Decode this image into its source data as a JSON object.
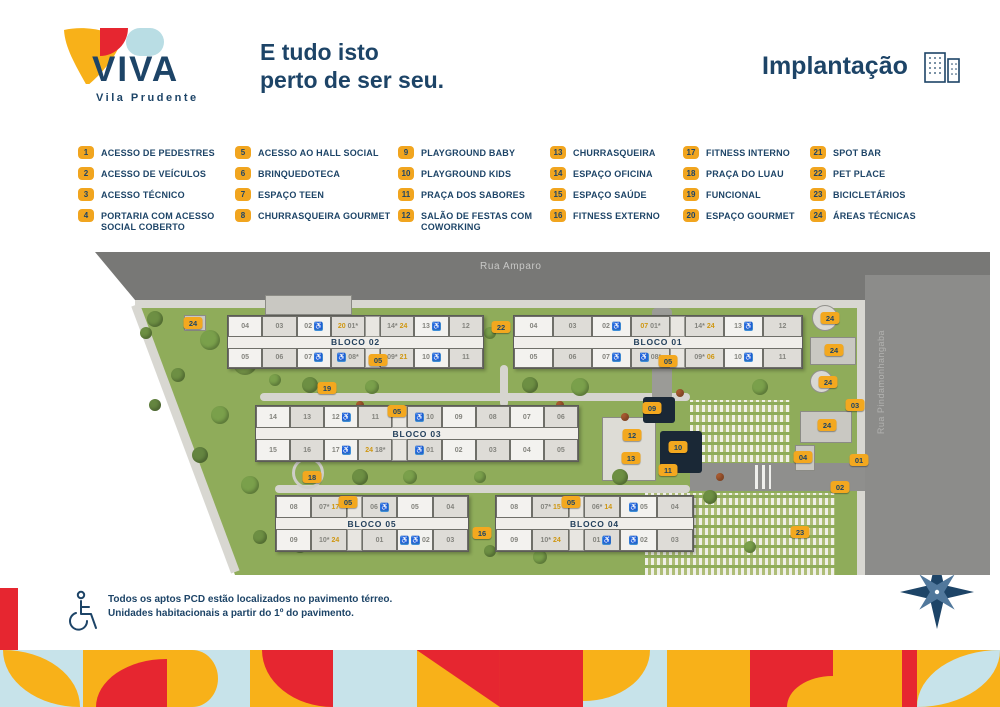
{
  "colors": {
    "navy": "#1d4467",
    "red": "#e62630",
    "yellow": "#f8b119",
    "legend_badge": "#f1a51f",
    "light_blue": "#c7e3ea",
    "grass": "#8fac5a",
    "road": "#787876",
    "accessibility_blue": "#3f8fd8",
    "gold": "#cf9712"
  },
  "icons": {
    "accessibility_glyph": "♿"
  },
  "header": {
    "logo_text": "VIVA",
    "logo_subtitle": "Vila Prudente",
    "tagline_line1": "E tudo isto",
    "tagline_line2": "perto de ser seu.",
    "section_title": "Implantação"
  },
  "legend": {
    "columns": [
      [
        {
          "num": "1",
          "label": "ACESSO DE PEDESTRES"
        },
        {
          "num": "2",
          "label": "ACESSO DE VEÍCULOS"
        },
        {
          "num": "3",
          "label": "ACESSO TÉCNICO"
        },
        {
          "num": "4",
          "label": "PORTARIA COM ACESSO SOCIAL COBERTO"
        }
      ],
      [
        {
          "num": "5",
          "label": "ACESSO AO HALL SOCIAL"
        },
        {
          "num": "6",
          "label": "BRINQUEDOTECA"
        },
        {
          "num": "7",
          "label": "ESPAÇO TEEN"
        },
        {
          "num": "8",
          "label": "CHURRASQUEIRA GOURMET"
        }
      ],
      [
        {
          "num": "9",
          "label": "PLAYGROUND BABY"
        },
        {
          "num": "10",
          "label": "PLAYGROUND KIDS"
        },
        {
          "num": "11",
          "label": "PRAÇA DOS SABORES"
        },
        {
          "num": "12",
          "label": "SALÃO DE FESTAS COM COWORKING"
        }
      ],
      [
        {
          "num": "13",
          "label": "CHURRASQUEIRA"
        },
        {
          "num": "14",
          "label": "ESPAÇO OFICINA"
        },
        {
          "num": "15",
          "label": "ESPAÇO SAÚDE"
        },
        {
          "num": "16",
          "label": "FITNESS EXTERNO"
        }
      ],
      [
        {
          "num": "17",
          "label": "FITNESS INTERNO"
        },
        {
          "num": "18",
          "label": "PRAÇA DO LUAU"
        },
        {
          "num": "19",
          "label": "FUNCIONAL"
        },
        {
          "num": "20",
          "label": "ESPAÇO GOURMET"
        }
      ],
      [
        {
          "num": "21",
          "label": "SPOT BAR"
        },
        {
          "num": "22",
          "label": "PET PLACE"
        },
        {
          "num": "23",
          "label": "BICICLETÁRIOS"
        },
        {
          "num": "24",
          "label": "ÁREAS TÉCNICAS"
        }
      ]
    ]
  },
  "map": {
    "street_top": "Rua Amparo",
    "street_right": "Rua Pindamonhangaba",
    "blocks": [
      {
        "name": "BLOCO 02",
        "x": 167,
        "y": 70,
        "w": 255,
        "h": 52,
        "top": [
          {
            "p": [
              [
                "u",
                "04"
              ]
            ]
          },
          {
            "p": [
              [
                "u",
                "03"
              ]
            ]
          },
          {
            "p": [
              [
                "u",
                "02"
              ],
              [
                "w"
              ]
            ]
          },
          {
            "p": [
              [
                "g",
                "20"
              ],
              [
                "u",
                "01*"
              ]
            ]
          },
          {
            "e": 1
          },
          {
            "p": [
              [
                "u",
                "14*"
              ],
              [
                "g",
                "24"
              ]
            ]
          },
          {
            "p": [
              [
                "u",
                "13"
              ],
              [
                "w"
              ]
            ]
          },
          {
            "p": [
              [
                "u",
                "12"
              ]
            ]
          }
        ],
        "bottom": [
          {
            "p": [
              [
                "u",
                "05"
              ]
            ]
          },
          {
            "p": [
              [
                "u",
                "06"
              ]
            ]
          },
          {
            "p": [
              [
                "u",
                "07"
              ],
              [
                "w"
              ]
            ]
          },
          {
            "p": [
              [
                "w"
              ],
              [
                "u",
                "08*"
              ]
            ]
          },
          {
            "e": 1
          },
          {
            "p": [
              [
                "u",
                "09*"
              ],
              [
                "g",
                "21"
              ]
            ]
          },
          {
            "p": [
              [
                "u",
                "10"
              ],
              [
                "w"
              ]
            ]
          },
          {
            "p": [
              [
                "u",
                "11"
              ]
            ]
          }
        ]
      },
      {
        "name": "BLOCO 01",
        "x": 453,
        "y": 70,
        "w": 288,
        "h": 52,
        "top": [
          {
            "p": [
              [
                "u",
                "04"
              ]
            ]
          },
          {
            "p": [
              [
                "u",
                "03"
              ]
            ]
          },
          {
            "p": [
              [
                "u",
                "02"
              ],
              [
                "w"
              ]
            ]
          },
          {
            "p": [
              [
                "g",
                "07"
              ],
              [
                "u",
                "01*"
              ]
            ]
          },
          {
            "e": 1
          },
          {
            "p": [
              [
                "u",
                "14*"
              ],
              [
                "g",
                "24"
              ]
            ]
          },
          {
            "p": [
              [
                "u",
                "13"
              ],
              [
                "w"
              ]
            ]
          },
          {
            "p": [
              [
                "u",
                "12"
              ]
            ]
          }
        ],
        "bottom": [
          {
            "p": [
              [
                "u",
                "05"
              ]
            ]
          },
          {
            "p": [
              [
                "u",
                "06"
              ]
            ]
          },
          {
            "p": [
              [
                "u",
                "07"
              ],
              [
                "w"
              ]
            ]
          },
          {
            "p": [
              [
                "w"
              ],
              [
                "u",
                "08*"
              ]
            ]
          },
          {
            "e": 1
          },
          {
            "p": [
              [
                "u",
                "09*"
              ],
              [
                "g",
                "06"
              ]
            ]
          },
          {
            "p": [
              [
                "u",
                "10"
              ],
              [
                "w"
              ]
            ]
          },
          {
            "p": [
              [
                "u",
                "11"
              ]
            ]
          }
        ]
      },
      {
        "name": "BLOCO 03",
        "x": 195,
        "y": 160,
        "w": 322,
        "h": 55,
        "top": [
          {
            "p": [
              [
                "u",
                "14"
              ]
            ]
          },
          {
            "p": [
              [
                "u",
                "13"
              ]
            ]
          },
          {
            "p": [
              [
                "u",
                "12"
              ],
              [
                "w"
              ]
            ]
          },
          {
            "p": [
              [
                "u",
                "11"
              ]
            ]
          },
          {
            "e": 1
          },
          {
            "p": [
              [
                "w"
              ],
              [
                "u",
                "10"
              ]
            ]
          },
          {
            "p": [
              [
                "u",
                "09"
              ]
            ]
          },
          {
            "p": [
              [
                "u",
                "08"
              ]
            ]
          },
          {
            "p": [
              [
                "u",
                "07"
              ]
            ]
          },
          {
            "p": [
              [
                "u",
                "06"
              ]
            ]
          }
        ],
        "bottom": [
          {
            "p": [
              [
                "u",
                "15"
              ]
            ]
          },
          {
            "p": [
              [
                "u",
                "16"
              ]
            ]
          },
          {
            "p": [
              [
                "u",
                "17"
              ],
              [
                "w"
              ]
            ]
          },
          {
            "p": [
              [
                "g",
                "24"
              ],
              [
                "u",
                "18*"
              ]
            ]
          },
          {
            "e": 1
          },
          {
            "p": [
              [
                "w"
              ],
              [
                "u",
                "01"
              ]
            ]
          },
          {
            "p": [
              [
                "u",
                "02"
              ]
            ]
          },
          {
            "p": [
              [
                "u",
                "03"
              ]
            ]
          },
          {
            "p": [
              [
                "u",
                "04"
              ]
            ]
          },
          {
            "p": [
              [
                "u",
                "05"
              ]
            ]
          }
        ]
      },
      {
        "name": "BLOCO 05",
        "x": 215,
        "y": 250,
        "w": 192,
        "h": 55,
        "top": [
          {
            "p": [
              [
                "u",
                "08"
              ]
            ]
          },
          {
            "p": [
              [
                "u",
                "07*"
              ],
              [
                "g",
                "17"
              ]
            ]
          },
          {
            "e": 1
          },
          {
            "p": [
              [
                "u",
                "06"
              ],
              [
                "w"
              ]
            ]
          },
          {
            "p": [
              [
                "u",
                "05"
              ]
            ]
          },
          {
            "p": [
              [
                "u",
                "04"
              ]
            ]
          }
        ],
        "bottom": [
          {
            "p": [
              [
                "u",
                "09"
              ]
            ]
          },
          {
            "p": [
              [
                "u",
                "10*"
              ],
              [
                "g",
                "24"
              ]
            ]
          },
          {
            "e": 1
          },
          {
            "p": [
              [
                "u",
                "01"
              ]
            ]
          },
          {
            "p": [
              [
                "w"
              ],
              [
                "w"
              ],
              [
                "u",
                "02"
              ]
            ]
          },
          {
            "p": [
              [
                "u",
                "03"
              ]
            ]
          }
        ]
      },
      {
        "name": "BLOCO 04",
        "x": 435,
        "y": 250,
        "w": 197,
        "h": 55,
        "top": [
          {
            "p": [
              [
                "u",
                "08"
              ]
            ]
          },
          {
            "p": [
              [
                "u",
                "07*"
              ],
              [
                "g",
                "15"
              ]
            ]
          },
          {
            "e": 1
          },
          {
            "p": [
              [
                "u",
                "06*"
              ],
              [
                "g",
                "14"
              ]
            ]
          },
          {
            "p": [
              [
                "w"
              ],
              [
                "u",
                "05"
              ]
            ]
          },
          {
            "p": [
              [
                "u",
                "04"
              ]
            ]
          }
        ],
        "bottom": [
          {
            "p": [
              [
                "u",
                "09"
              ]
            ]
          },
          {
            "p": [
              [
                "u",
                "10*"
              ],
              [
                "g",
                "24"
              ]
            ]
          },
          {
            "e": 1
          },
          {
            "p": [
              [
                "u",
                "01"
              ],
              [
                "w"
              ]
            ]
          },
          {
            "p": [
              [
                "w"
              ],
              [
                "u",
                "02"
              ]
            ]
          },
          {
            "p": [
              [
                "u",
                "03"
              ]
            ]
          }
        ]
      }
    ],
    "markers": [
      {
        "label": "24",
        "x": 133,
        "y": 78
      },
      {
        "label": "22",
        "x": 441,
        "y": 82
      },
      {
        "label": "05",
        "x": 318,
        "y": 115
      },
      {
        "label": "05",
        "x": 608,
        "y": 116
      },
      {
        "label": "19",
        "x": 267,
        "y": 143
      },
      {
        "label": "05",
        "x": 337,
        "y": 166
      },
      {
        "label": "09",
        "x": 592,
        "y": 163
      },
      {
        "label": "12",
        "x": 572,
        "y": 190
      },
      {
        "label": "10",
        "x": 618,
        "y": 202
      },
      {
        "label": "13",
        "x": 571,
        "y": 213
      },
      {
        "label": "11",
        "x": 608,
        "y": 225
      },
      {
        "label": "18",
        "x": 252,
        "y": 232
      },
      {
        "label": "24",
        "x": 770,
        "y": 73
      },
      {
        "label": "24",
        "x": 774,
        "y": 105
      },
      {
        "label": "24",
        "x": 768,
        "y": 137
      },
      {
        "label": "03",
        "x": 795,
        "y": 160
      },
      {
        "label": "24",
        "x": 767,
        "y": 180
      },
      {
        "label": "04",
        "x": 743,
        "y": 212
      },
      {
        "label": "01",
        "x": 799,
        "y": 215
      },
      {
        "label": "02",
        "x": 780,
        "y": 242
      },
      {
        "label": "05",
        "x": 288,
        "y": 257
      },
      {
        "label": "05",
        "x": 511,
        "y": 257
      },
      {
        "label": "16",
        "x": 422,
        "y": 288
      },
      {
        "label": "23",
        "x": 740,
        "y": 287
      }
    ]
  },
  "footer": {
    "note_line1": "Todos os aptos PCD estão localizados no pavimento térreo.",
    "note_line2": "Unidades habitacionais a partir do 1º do pavimento.",
    "compass_label": "N"
  }
}
